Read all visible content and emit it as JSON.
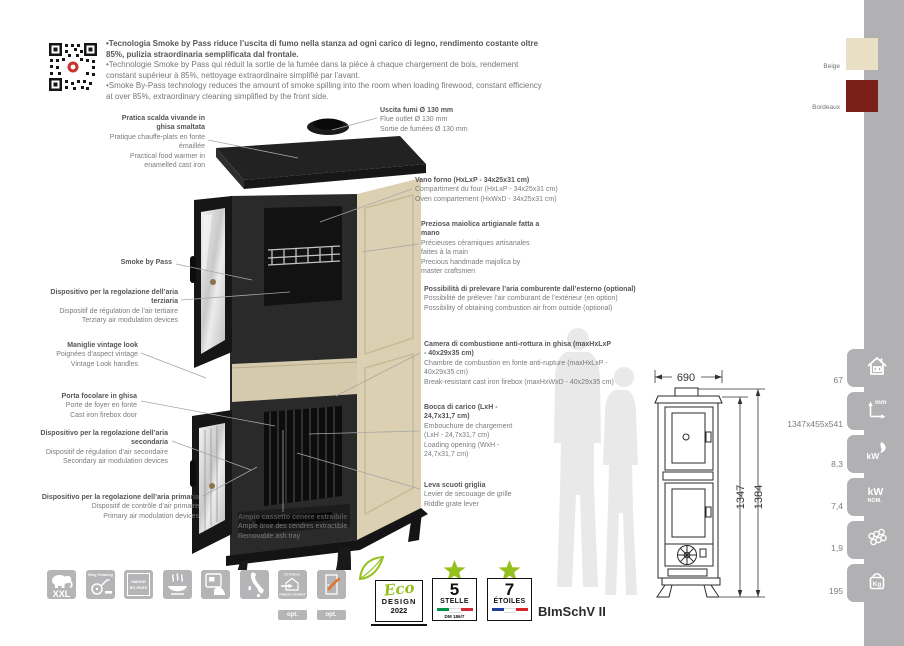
{
  "intro": {
    "it": "•Tecnologia Smoke by Pass riduce l’uscita di fumo nella stanza ad ogni carico di legno, rendimento costante oltre 85%, pulizia straordinaria semplificata dal frontale.",
    "fr": "•Technologie Smoke by Pass qui réduit la sortie de la fumée dans la pièce à chaque chargement de bois, rendement constant supérieur à 85%, nettoyage extraordinaire simplifié par l’avant.",
    "en": "•Smoke By-Pass technology reduces the amount of smoke spilling into the room when loading firewood, constant efficiency at over 85%, extraordinary cleaning simplified by the front side."
  },
  "swatches": [
    {
      "label": "Beige",
      "hex": "#e9dfc4"
    },
    {
      "label": "Bordeaux",
      "hex": "#7b2018"
    }
  ],
  "callouts_left": [
    {
      "it": "Pratica scalda vivande in ghisa smaltata",
      "fr": "Pratique chauffe-plats en fonte émaillée",
      "en": "Practical food warmer in enamelled cast iron"
    },
    {
      "it": "Smoke by Pass"
    },
    {
      "it": "Dispositivo per la regolazione dell’aria terziaria",
      "fr": "Dispositif de régulation de l’air tertiaire",
      "en": "Terziary air modulation devices"
    },
    {
      "it": "Maniglie vintage look",
      "fr": "Poignées d’aspect vintage",
      "en": "Vintage Look handles"
    },
    {
      "it": "Porta focolare in ghisa",
      "fr": "Porte de foyer en fonte",
      "en": "Cast iron firebox door"
    },
    {
      "it": "Dispositivo per la regolazione dell’aria secondaria",
      "fr": "Dispositif de régulation d’air secondaire",
      "en": "Secondary air modulation devices"
    },
    {
      "it": "Dispositivo per la regolazione dell’aria primaria",
      "fr": "Dispositif de contrôle d’air primaire",
      "en": "Primary air modulation devices"
    },
    {
      "it": "Ampio cassetto cenere estraibile",
      "fr": "Ample tiroir des cendres extractible",
      "en": "Removable ash tray"
    }
  ],
  "callouts_right": [
    {
      "it": "Uscita fumi Ø 130 mm",
      "l2": "Flue outlet Ø 130 mm",
      "l3": "Sortie de fumées Ø 130 mm"
    },
    {
      "it": "Vano forno (HxLxP - 34x25x31 cm)",
      "l2": "Compartiment du four (HxLxP - 34x25x31 cm)",
      "l3": "Oven compartement (HxWxD - 34x25x31 cm)"
    },
    {
      "it": "Preziosa maiolica artigianale fatta a mano",
      "l2": "Précieuses céramiques artisanales faites à la main",
      "l3": "Precious handmade majolica by master craftsmen"
    },
    {
      "it": "Possibilità di prelevare l’aria comburente dall’esterno (optional)",
      "l2": "Possibilité de prélever l’air comburant de l’extérieur (en option)",
      "l3": "Possibility of obtaining combustion air from outside (optional)"
    },
    {
      "it": "Camera di combustione anti-rottura in ghisa (maxHxLxP - 40x29x35 cm)",
      "l2": "Chambre de combustion en fonte anti-rupture (maxHxLxP - 40x29x35 cm)",
      "l3": "Break-resistant cast iron firebox (maxHxWxD - 40x29x35 cm)"
    },
    {
      "it": "Bocca di carico (LxH - 24,7x31,7 cm)",
      "l2": "Embouchure de chargement (LxH - 24,7x31,7 cm)",
      "l3": "Loading opening (WxH - 24,7x31,7 cm)"
    },
    {
      "it": "Leva scuoti griglia",
      "l2": "Levier de secouage de grille",
      "l3": "Riddle grate lever"
    }
  ],
  "dimensions": {
    "width": "690",
    "h1": "1347",
    "h2": "1384"
  },
  "specs": [
    {
      "name": "heatable-volume",
      "value": "67"
    },
    {
      "name": "dimensions-mm",
      "value": "1347x455x541",
      "icon_label": "mm"
    },
    {
      "name": "kw-global",
      "value": "8,3",
      "icon_label": "kW"
    },
    {
      "name": "kw-nominal",
      "value": "7,4",
      "icon_label": "kW",
      "icon_sub": "NOM."
    },
    {
      "name": "wood-consumption",
      "value": "1,9"
    },
    {
      "name": "weight-kg",
      "value": "195",
      "icon_label": "Kg"
    }
  ],
  "features": [
    {
      "name": "xxl",
      "label": "XXL"
    },
    {
      "name": "easy-cleaning",
      "label": "Easy Cleaning"
    },
    {
      "name": "smoke-by-pass",
      "line1": "SMOKE",
      "line2": "BY-PASS"
    },
    {
      "name": "food-warmer"
    },
    {
      "name": "handmade-majolica"
    },
    {
      "name": "made-in-italy"
    },
    {
      "name": "external-primary-air",
      "top": "EXTERNAL",
      "bottom": "PRIMARY AIR INPUT",
      "opt": "opt."
    },
    {
      "name": "external-air-kit",
      "opt": "opt."
    }
  ],
  "badges": {
    "eco": {
      "script": "Eco",
      "design": "DESIGN",
      "year": "2022"
    },
    "stelle": {
      "number": "5",
      "label": "STELLE",
      "sub": "DM 186/7"
    },
    "etoiles": {
      "number": "7",
      "label": "ÉTOILES"
    },
    "cert": "BImSchV II"
  },
  "colors": {
    "accent_green": "#95c11f",
    "strip_gray": "#b1b0b2",
    "beige": "#e9dfc4",
    "bordeaux": "#7b2018"
  }
}
